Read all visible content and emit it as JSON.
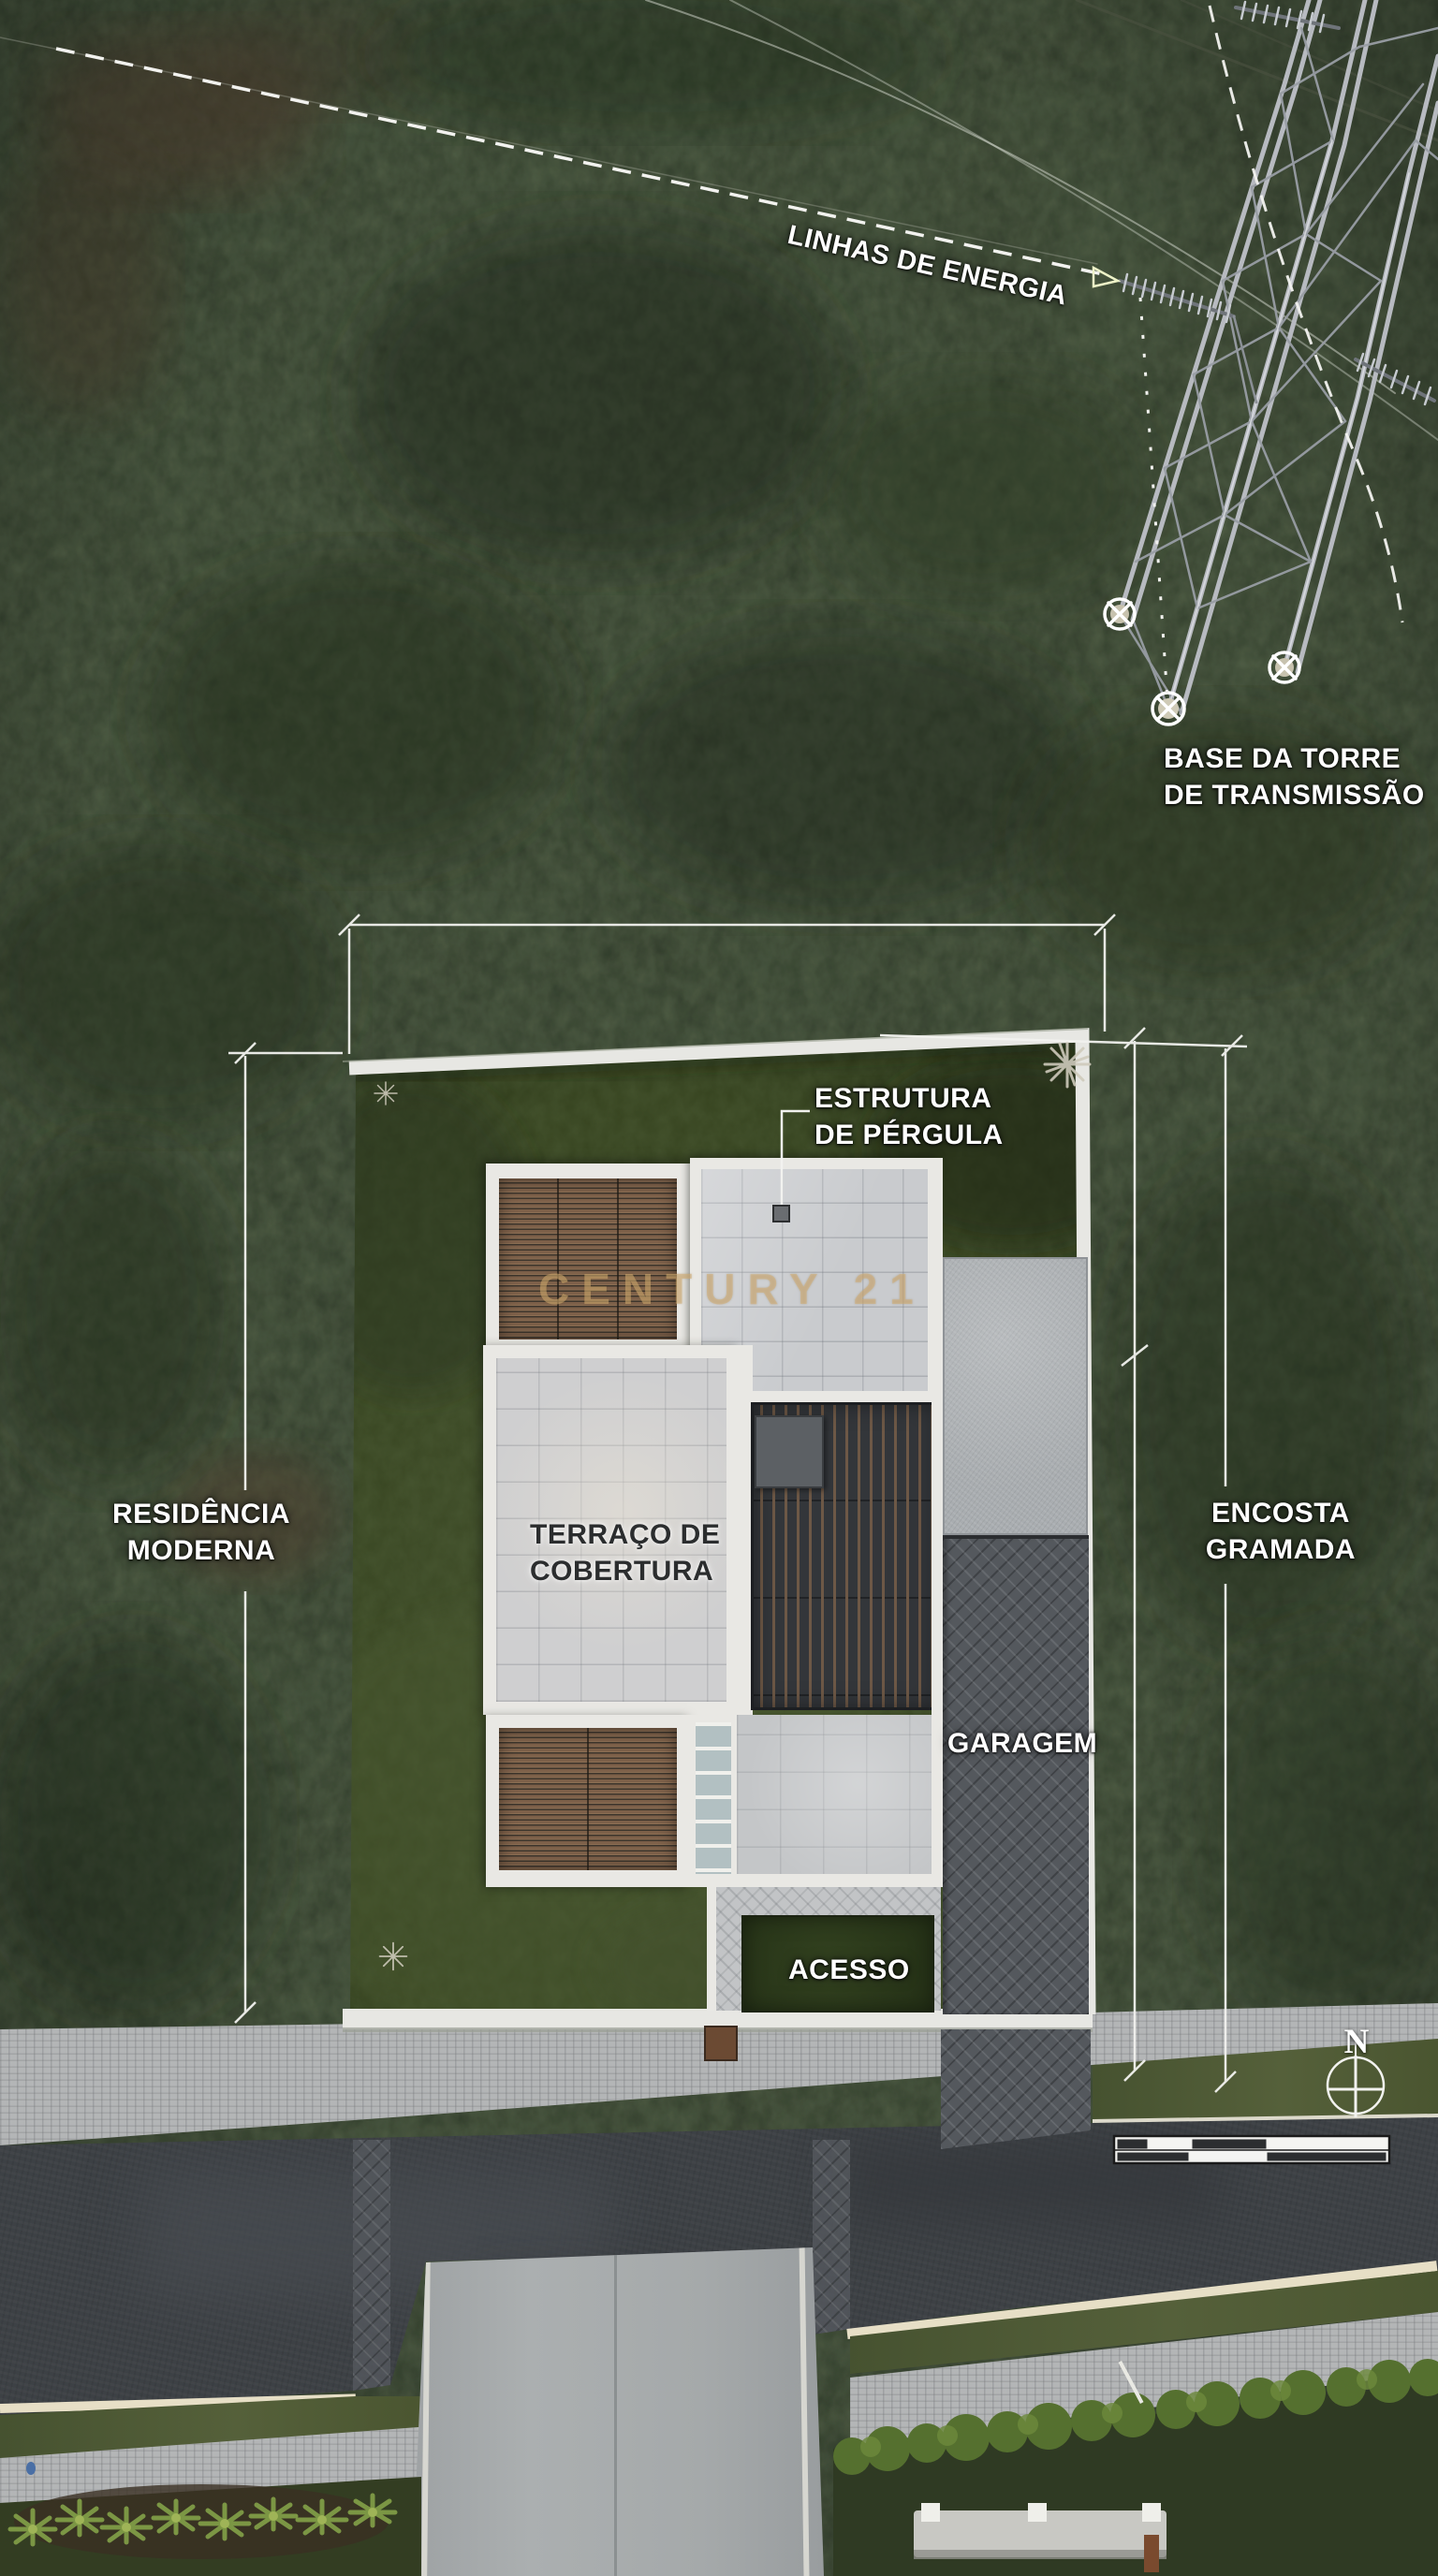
{
  "meta": {
    "description": "Aerial drone site-plan photo of a modern residence with Portuguese architectural annotations",
    "language": "pt-BR"
  },
  "labels": {
    "power_lines": "LINHAS DE ENERGIA",
    "tower_base_line1": "BASE DA TORRE",
    "tower_base_line2": "DE TRANSMISSÃO",
    "pergola_line1": "ESTRUTURA",
    "pergola_line2": "DE PÉRGULA",
    "residence_line1": "RESIDÊNCIA",
    "residence_line2": "MODERNA",
    "slope_line1": "ENCOSTA",
    "slope_line2": "GRAMADA",
    "roof_terrace_line1": "TERRAÇO DE",
    "roof_terrace_line2": "COBERTURA",
    "garage": "GARAGEM",
    "access": "ACESSO"
  },
  "watermark": "CENTURY 21",
  "compass": {
    "north": "N"
  },
  "colors": {
    "annotation_white": "#f2f2ef",
    "dark_label": "#2b2d2e",
    "watermark_gold": "#d3ad72",
    "lawn_green": "#3b4a2a",
    "terrain_green": "#2e3827",
    "asphalt_gray": "#3d4145",
    "roof_white": "#e9e8e4"
  }
}
